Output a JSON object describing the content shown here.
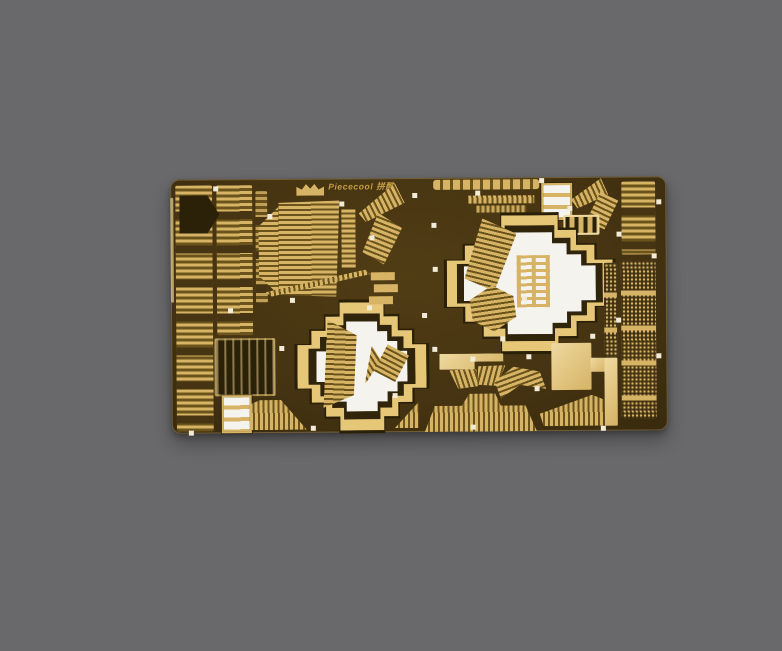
{
  "image": {
    "type": "product-photo",
    "subject": "Piececool photo-etched gold metal model-kit fret sheet with castle roof parts, two stepped-cross cutouts, on plain gray backdrop",
    "background_color": "#69696b"
  },
  "sheet": {
    "brand": "Piececool 拼酷",
    "logo_icon": "crown-icon",
    "colors": {
      "base_dark": "#463412",
      "gold": "#d6b365",
      "gold_light": "#eed9a0",
      "gold_frame": "#e6c778",
      "stripe_gap": "#6b541c",
      "cutout_white": "#f5f3ee",
      "dark_part": "#2b2109"
    }
  }
}
